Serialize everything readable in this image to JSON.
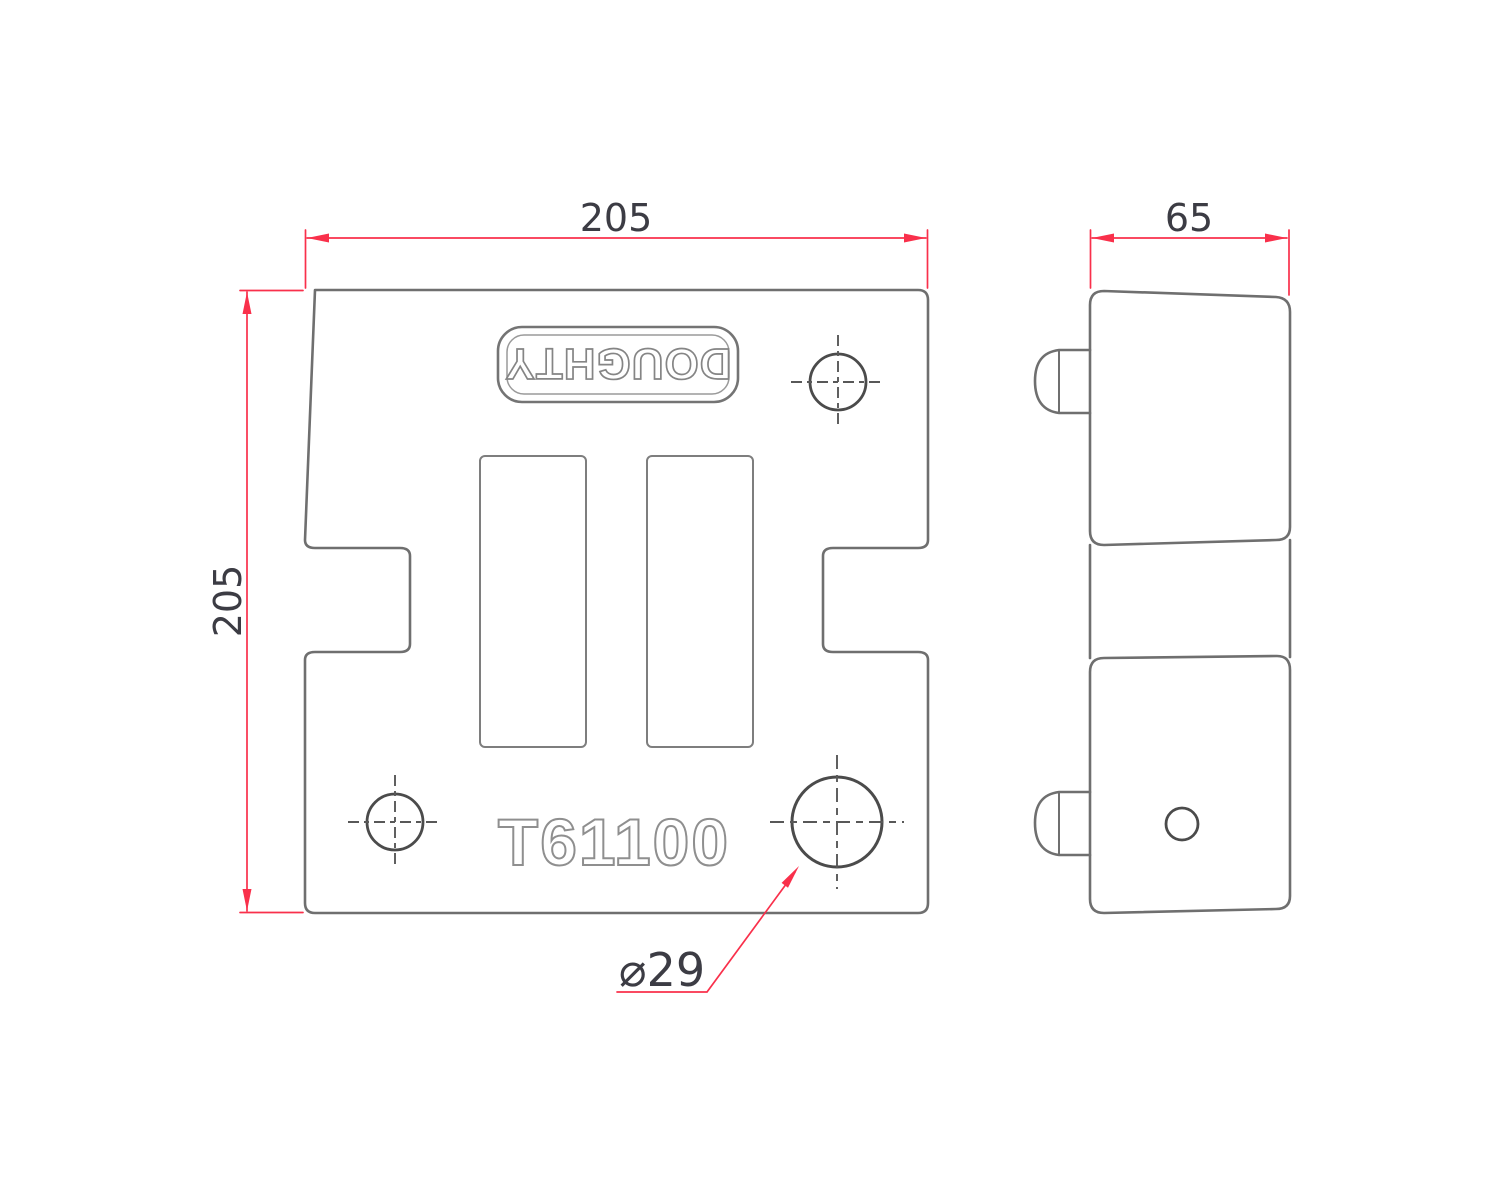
{
  "drawing": {
    "brand_label": "DOUGHTY",
    "part_number": "T61100",
    "dim_front_width": "205",
    "dim_front_height": "205",
    "dim_side_depth": "65",
    "dim_hole_diameter": "⌀29",
    "colors": {
      "dimension_red": "#f9304b",
      "line_gray": "#6f6f6f",
      "hole_gray": "#4b4b4b",
      "text_dark": "#3c3c44",
      "background": "#ffffff"
    }
  }
}
